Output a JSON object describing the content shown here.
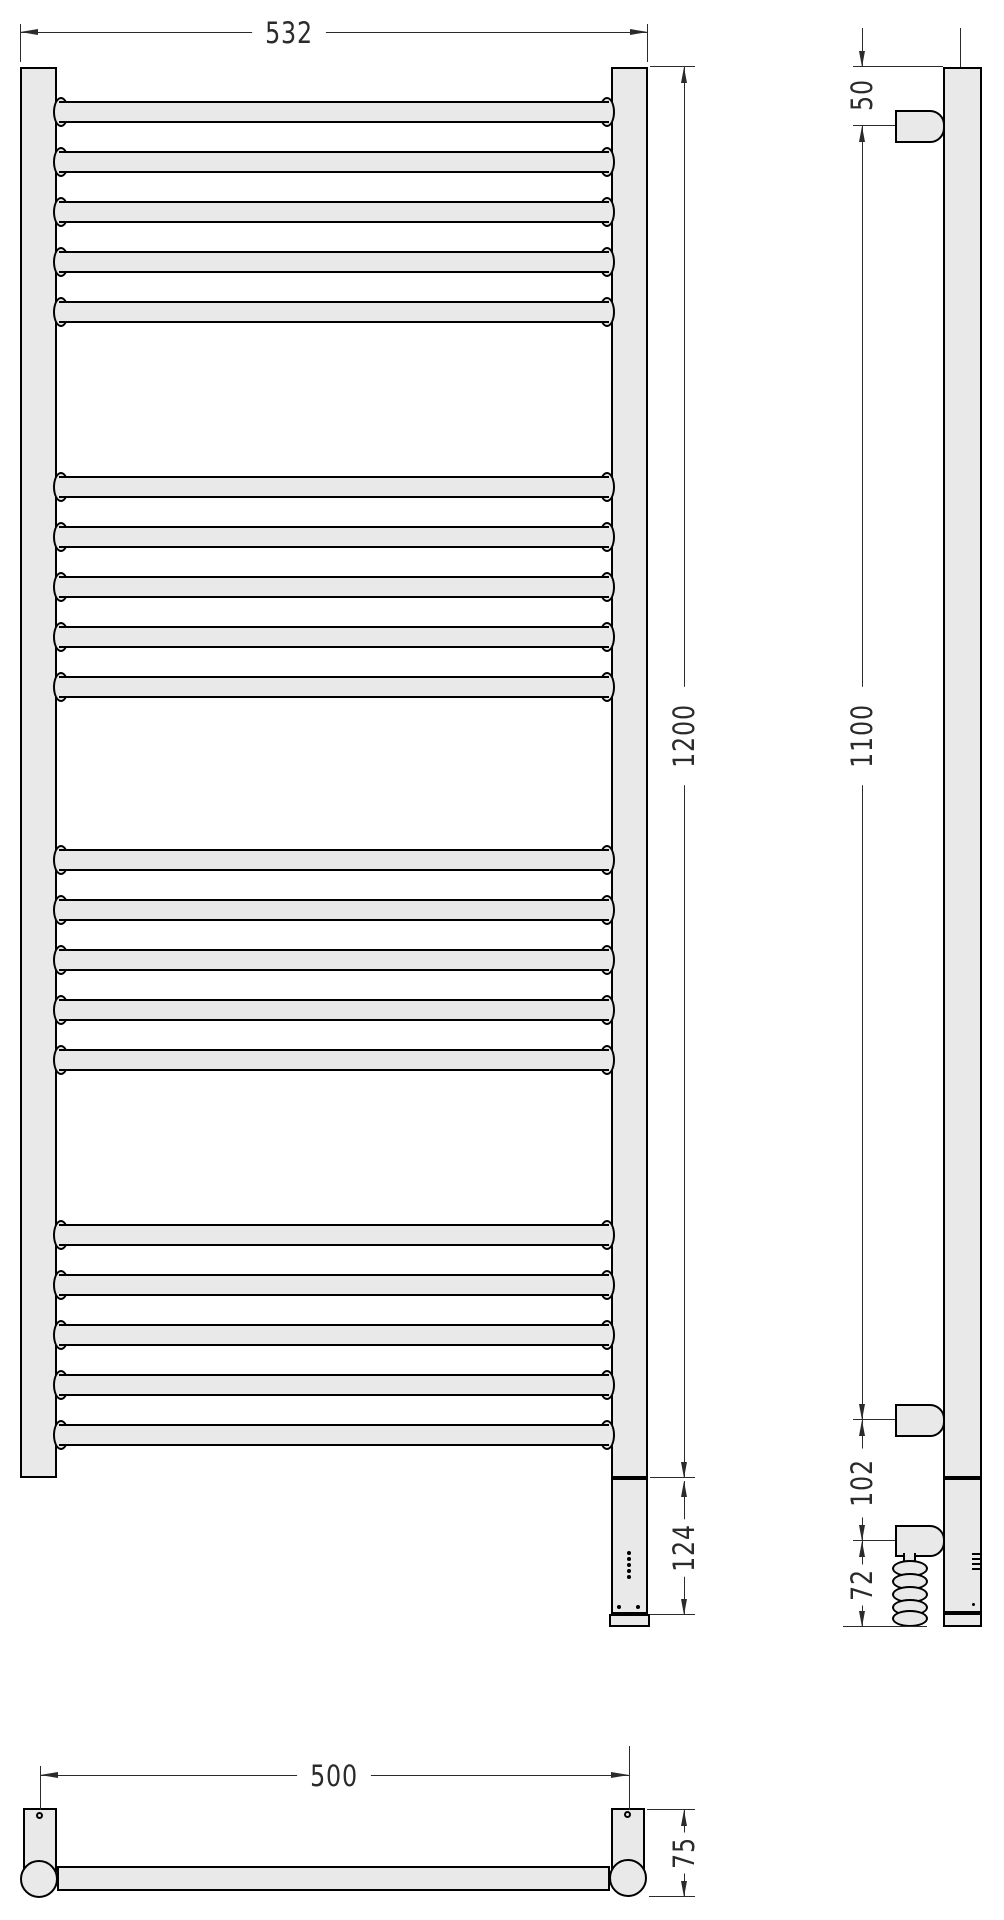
{
  "drawing": {
    "type": "towel-rail-technical-drawing",
    "views": [
      "front",
      "side",
      "bottom"
    ]
  },
  "dims": {
    "front_width": "532",
    "front_height": "1200",
    "control_unit_height": "124",
    "top_rung_offset": "50",
    "rung_span": "1100",
    "heater_offset": "102",
    "cable_drop": "72",
    "mount_hole_span": "500",
    "bracket_depth": "75"
  },
  "front_view": {
    "rung_count": 20,
    "groups": 4,
    "rungs_per_group": 5,
    "rung_tops": [
      101,
      151,
      201,
      251,
      301,
      476,
      526,
      576,
      626,
      676,
      849,
      899,
      949,
      999,
      1049,
      1224,
      1274,
      1324,
      1374,
      1424
    ],
    "led_dot_tops": [
      1551,
      1557,
      1563,
      1569,
      1575
    ]
  },
  "side_view": {
    "coil_loop_tops": [
      1560,
      1573,
      1586,
      1599,
      1610
    ],
    "vent_tops": [
      1553,
      1558,
      1563,
      1568
    ]
  },
  "colors": {
    "fill": "#e9e9e9",
    "outline": "#000000",
    "dimension": "#2b2b2b",
    "background": "#ffffff"
  }
}
